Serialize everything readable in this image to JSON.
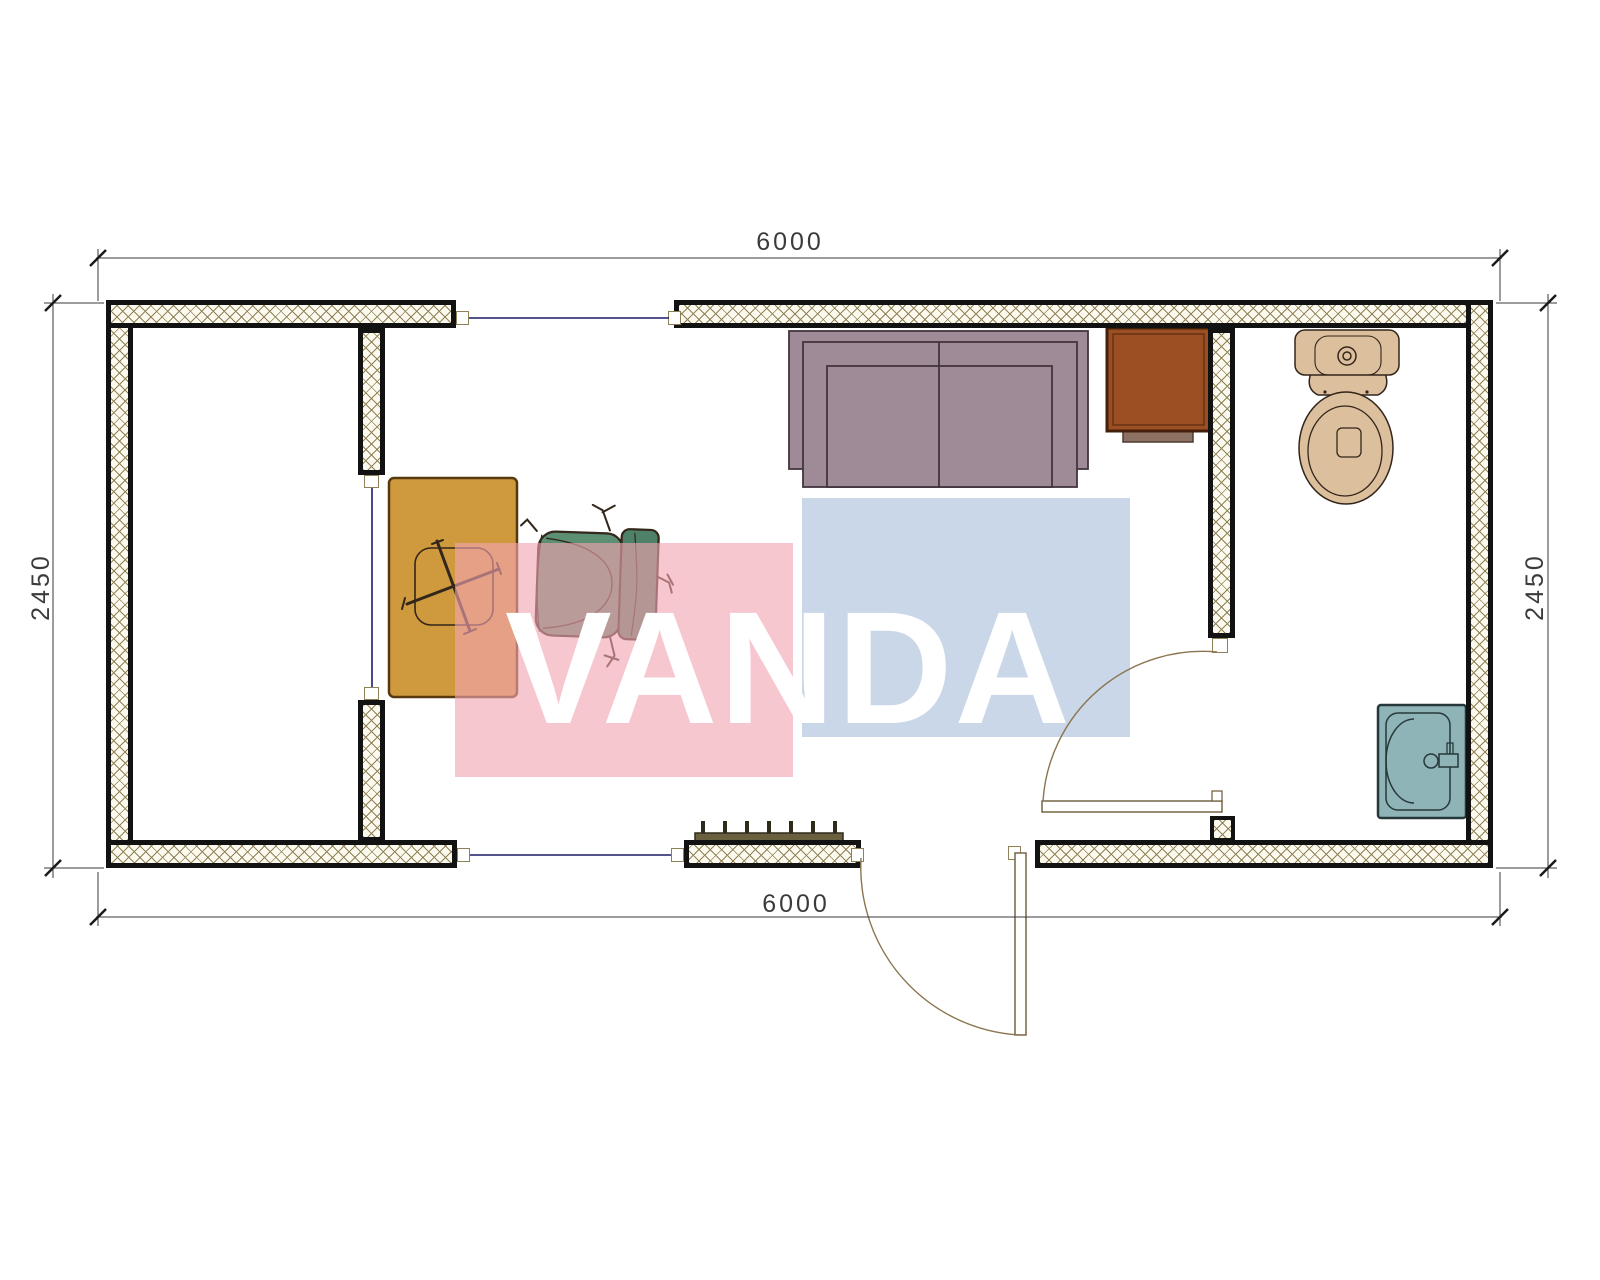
{
  "drawing": {
    "type": "container-office floor plan",
    "watermark": {
      "text": "VANDA"
    },
    "dimensions": {
      "top": "6000",
      "bottom": "6000",
      "left": "2450",
      "right": "2450"
    },
    "furniture": [
      {
        "name": "desk-icon"
      },
      {
        "name": "office-chair-icon"
      },
      {
        "name": "sofa-icon"
      },
      {
        "name": "cabinet-icon"
      },
      {
        "name": "toilet-icon"
      },
      {
        "name": "sink-icon"
      },
      {
        "name": "radiator-icon"
      }
    ],
    "colors": {
      "wall-hatch": "#8f8157",
      "window-line": "#1c1c66",
      "door-line": "#8a7550",
      "dim-line": "#3a3a3a",
      "dim-text": "#3b3b3b",
      "desk": "#cf9a3e",
      "chair": "#5d8f75",
      "chair-back": "#4f8168",
      "chair-outline": "#33261a",
      "sofa": "#9e8b97",
      "sofa-outline": "#42343e",
      "cabinet": "#9d4f24",
      "cabinet-tab": "#8d7264",
      "toilet": "#dcc09e",
      "toilet-outline": "#33251a",
      "sink": "#8fb4b7",
      "sink-outline": "#26383a",
      "radiator": "#6a6040",
      "radiator-fin": "#2f2b1a",
      "watermark-pink": "rgba(242,165,178,0.62)",
      "watermark-blue": "rgba(162,186,215,0.58)",
      "watermark-text": "#ffffff"
    }
  }
}
